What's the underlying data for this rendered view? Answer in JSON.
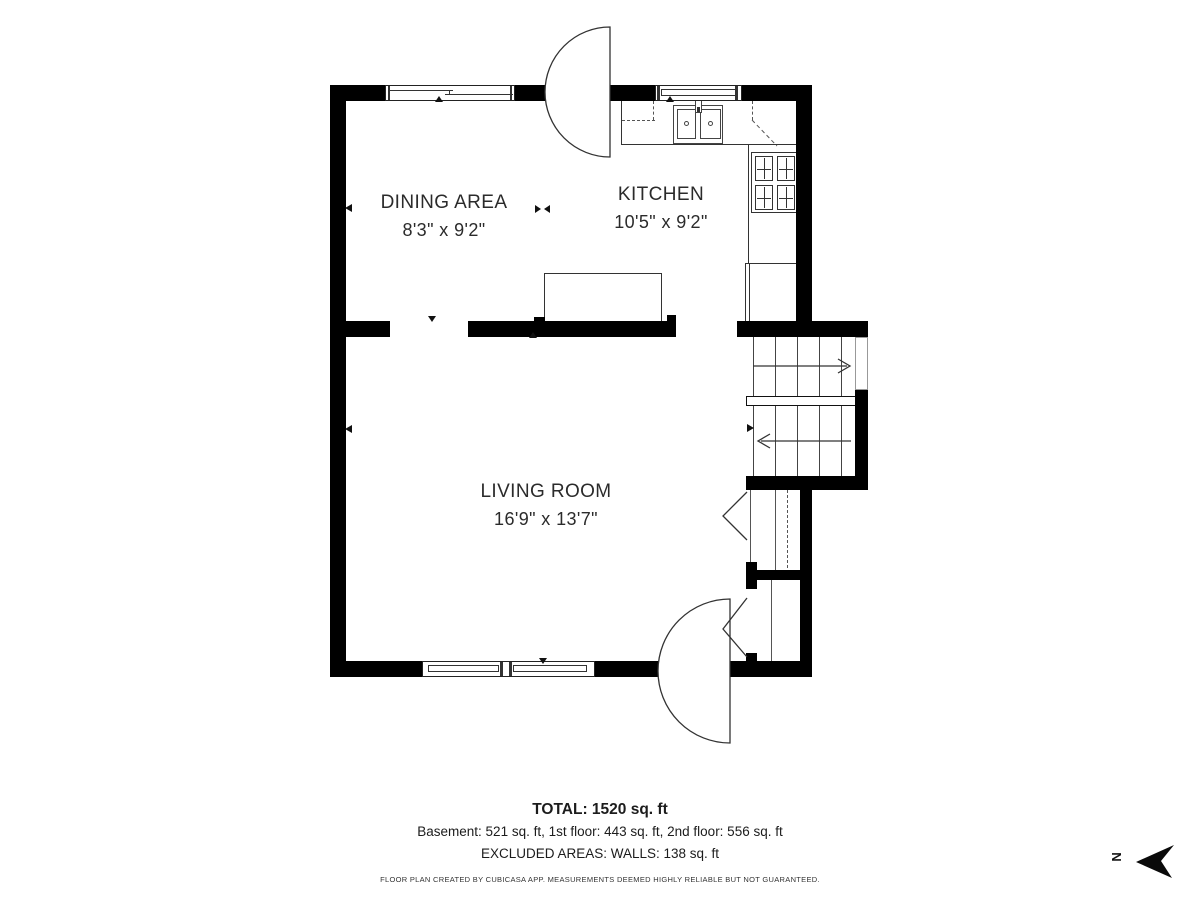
{
  "plan": {
    "rooms": {
      "dining": {
        "name": "DINING AREA",
        "dims": "8'3\" x 9'2\""
      },
      "kitchen": {
        "name": "KITCHEN",
        "dims": "10'5\" x 9'2\""
      },
      "living": {
        "name": "LIVING ROOM",
        "dims": "16'9\" x 13'7\""
      }
    }
  },
  "footer": {
    "total": "TOTAL: 1520 sq. ft",
    "breakdown": "Basement: 521 sq. ft, 1st floor: 443 sq. ft, 2nd floor: 556 sq. ft",
    "excluded": "EXCLUDED AREAS: WALLS: 138 sq. ft",
    "disclaimer": "FLOOR PLAN CREATED BY CUBICASA APP. MEASUREMENTS DEEMED HIGHLY RELIABLE BUT NOT GUARANTEED."
  },
  "compass": {
    "letter": "N"
  },
  "colors": {
    "wall": "#000000",
    "line": "#333333",
    "text": "#2b2b2b"
  }
}
